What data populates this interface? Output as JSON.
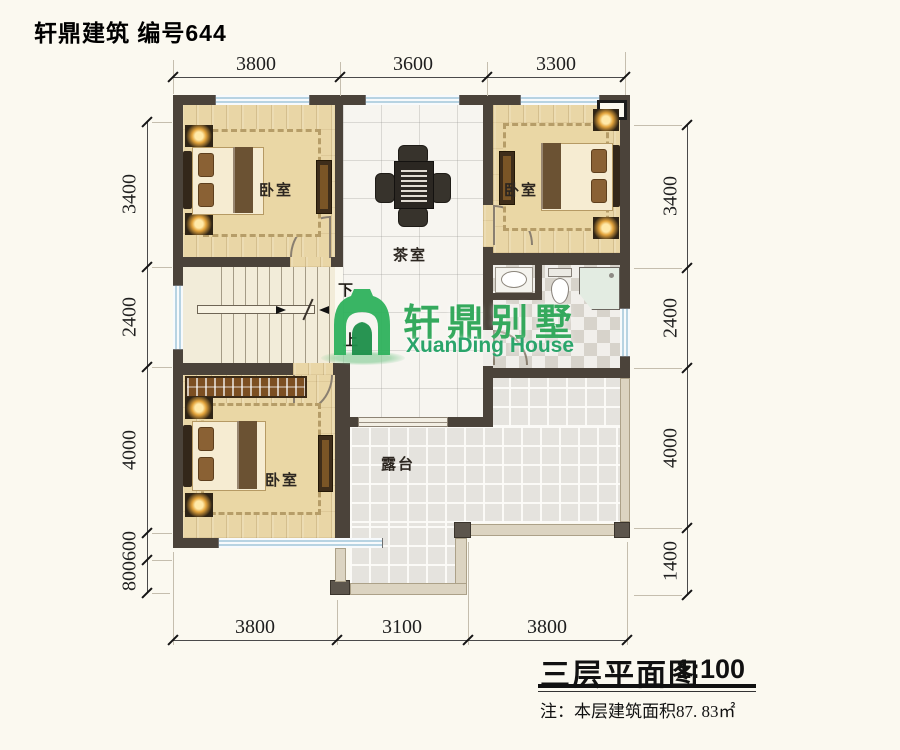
{
  "header": {
    "title": "轩鼎建筑 编号644"
  },
  "logo": {
    "icon": "green-arch-house-icon",
    "cn": "轩鼎别墅",
    "en": "XuanDing House"
  },
  "rooms": {
    "bedroom": "卧室",
    "tea_room": "茶室",
    "terrace": "露台"
  },
  "stairs": {
    "down": "下",
    "up": "上"
  },
  "dims": {
    "top": [
      "3800",
      "3600",
      "3300"
    ],
    "bottom": [
      "3800",
      "3100",
      "3800"
    ],
    "left": [
      "3400",
      "2400",
      "4000",
      "600",
      "800"
    ],
    "right": [
      "3400",
      "2400",
      "4000",
      "1400"
    ]
  },
  "titleblock": {
    "name": "三层平面图",
    "scale": "1:100",
    "note": "注：本层建筑面积87. 83㎡"
  },
  "colors": {
    "wall": "#4b433a",
    "wood_floor": "#e9d6a6",
    "marble_floor": "#f7f5f0",
    "terrace_floor": "#e5e3de",
    "window_blue": "#b7d3e2",
    "parapet": "#dcd4c1",
    "logo_green": "#35a95d",
    "lamp_glow": "#ffe9a8"
  }
}
